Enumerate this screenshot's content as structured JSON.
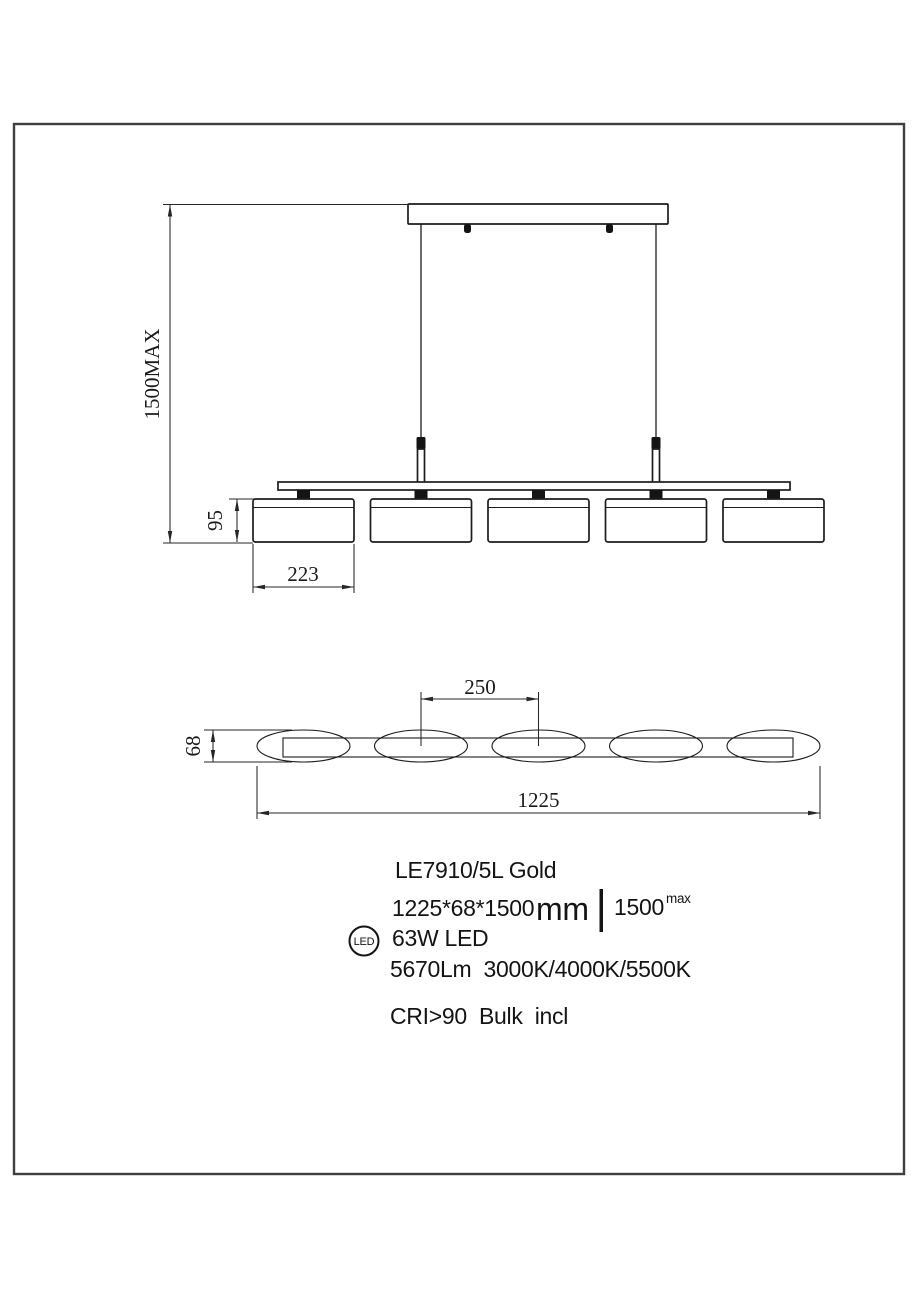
{
  "page": {
    "background": "#ffffff",
    "line_color": "#1c1c1c",
    "border_color": "#3f3f3f"
  },
  "front_view": {
    "dim_max_drop": "1500MAX",
    "dim_shade_height": "95",
    "dim_shade_width": "223"
  },
  "top_view": {
    "dim_shade_spacing": "250",
    "dim_body_depth": "68",
    "dim_overall_length": "1225"
  },
  "specs": {
    "model": "LE7910/5L Gold",
    "size_value": "1225*68*1500",
    "size_unit": "mm",
    "max_drop_value": "1500",
    "max_drop_suffix": "max",
    "led_badge": "LED",
    "wattage": "63W LED",
    "output": "5670Lm  3000K/4000K/5500K",
    "cri_line": "CRI>90  Bulk  incl"
  }
}
